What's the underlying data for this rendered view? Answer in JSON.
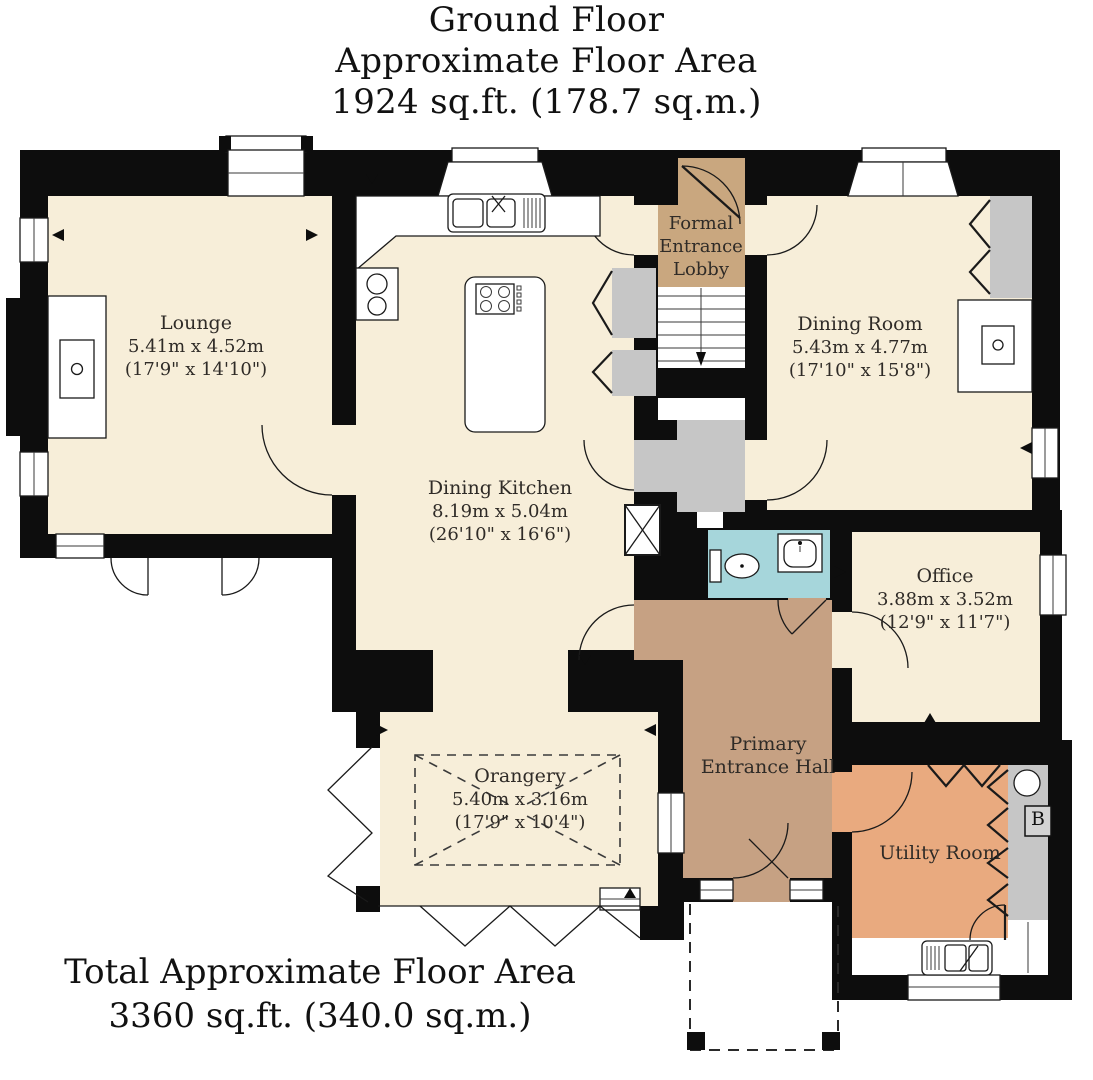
{
  "header": {
    "line1": "Ground Floor",
    "line2": "Approximate Floor Area",
    "line3": "1924 sq.ft. (178.7 sq.m.)"
  },
  "footer": {
    "line1": "Total Approximate Floor Area",
    "line2": "3360 sq.ft. (340.0 sq.m.)"
  },
  "rooms": {
    "lounge": {
      "name": "Lounge",
      "metric": "5.41m x 4.52m",
      "imperial": "(17'9\" x 14'10\")"
    },
    "dining_kitchen": {
      "name": "Dining Kitchen",
      "metric": "8.19m x 5.04m",
      "imperial": "(26'10\" x 16'6\")"
    },
    "formal_entrance_lobby": {
      "name": "Formal Entrance Lobby"
    },
    "dining_room": {
      "name": "Dining Room",
      "metric": "5.43m x 4.77m",
      "imperial": "(17'10\" x 15'8\")"
    },
    "office": {
      "name": "Office",
      "metric": "3.88m x 3.52m",
      "imperial": "(12'9\" x 11'7\")"
    },
    "orangery": {
      "name": "Orangery",
      "metric": "5.40m x 3.16m",
      "imperial": "(17'9\" x 10'4\")"
    },
    "primary_entrance_hall": {
      "name": "Primary Entrance Hall"
    },
    "utility_room": {
      "name": "Utility Room"
    },
    "boiler": {
      "label": "B"
    }
  },
  "colors": {
    "room_fill": "#f7eed9",
    "lobby_fill": "#c9a77f",
    "hall_fill": "#c6a183",
    "utility_fill": "#e9aa7f",
    "wc_fill": "#a6d6db",
    "cupboard_fill": "#c6c6c6",
    "wall": "#0d0d0d",
    "label_text": "#2f2b27"
  }
}
